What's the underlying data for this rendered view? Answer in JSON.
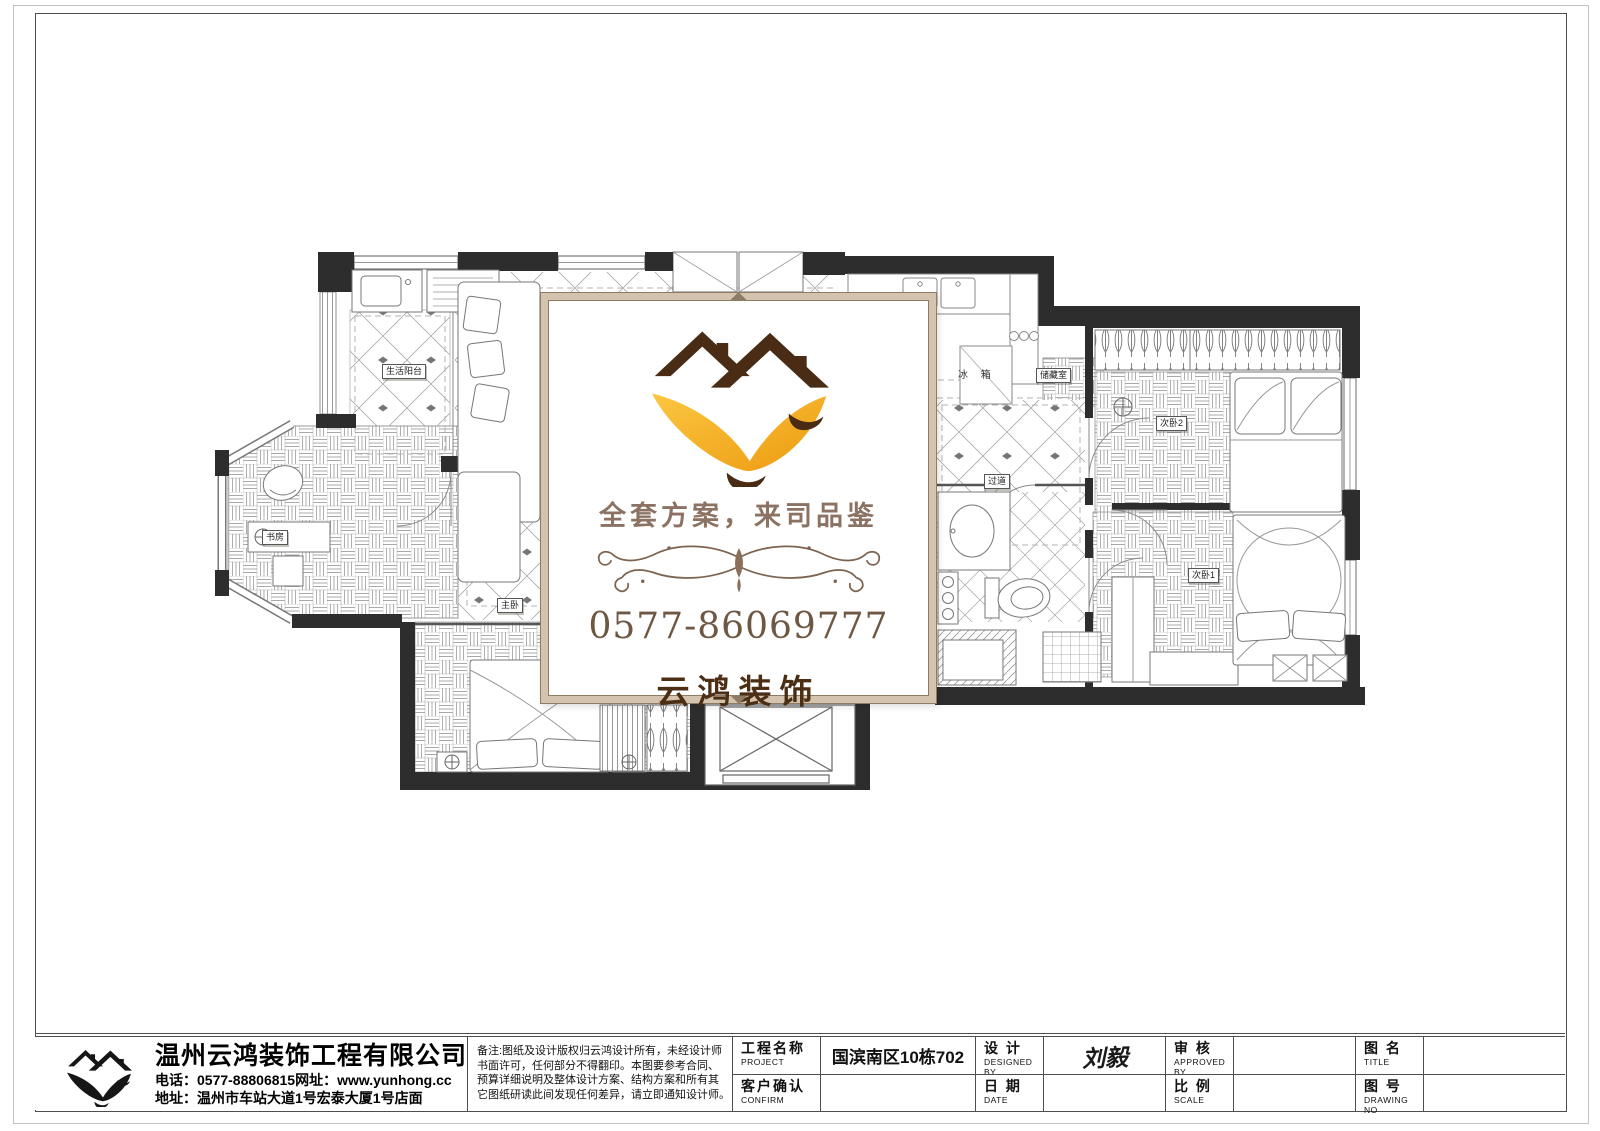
{
  "watermark": {
    "tagline": "全套方案，来司品鉴",
    "phone": "0577-86069777",
    "brand": "云鸿装饰",
    "accent_orange": "#F2A31D",
    "accent_brown": "#4B2E14",
    "frame_tan": "#D4C3AE"
  },
  "company": {
    "name": "温州云鸿装饰工程有限公司",
    "phone_line": "电话：0577-88806815网址：www.yunhong.cc",
    "address_line": "地址：温州市车站大道1号宏泰大厦1号店面"
  },
  "notes": {
    "line1": "备注:图纸及设计版权归云鸿设计所有，未经设计师",
    "line2": "书面许可，任何部分不得翻印。本图要参考合同、",
    "line3": "预算详细说明及整体设计方案、结构方案和所有其",
    "line4": "它图纸研读此间发现任何差异，请立即通知设计师。"
  },
  "titleblock": {
    "project_label_cn": "工程名称",
    "project_label_en": "PROJECT",
    "project_value": "国滨南区10栋702",
    "confirm_label_cn": "客户确认",
    "confirm_label_en": "CONFIRM",
    "confirm_value": "",
    "design_label_cn": "设 计",
    "design_label_en": "DESIGNED BY",
    "design_value": "刘毅",
    "date_label_cn": "日 期",
    "date_label_en": "DATE",
    "date_value": "",
    "approve_label_cn": "审 核",
    "approve_label_en": "APPROVED BY",
    "approve_value": "",
    "scale_label_cn": "比 例",
    "scale_label_en": "SCALE",
    "scale_value": "",
    "title_label_cn": "图 名",
    "title_label_en": "TITLE",
    "title_value": "",
    "drawingno_label_cn": "图 号",
    "drawingno_label_en": "DRAWING NO",
    "drawingno_value": ""
  },
  "rooms": {
    "balcony": "生活阳台",
    "study": "书房",
    "master": "主卧",
    "fridge": "冰 箱",
    "storage": "储藏室",
    "corridor": "过道",
    "bedroom2": "次卧2",
    "bedroom1": "次卧1"
  }
}
